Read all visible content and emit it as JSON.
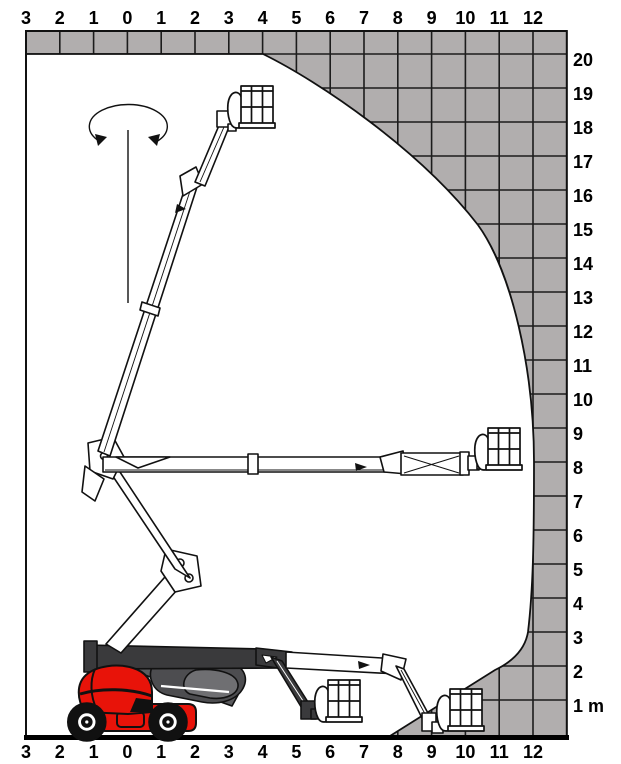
{
  "diagram": {
    "kind": "boom-lift-working-envelope",
    "unit": "m",
    "max_height_m": 20,
    "max_outreach_m": 12
  },
  "axes": {
    "top_labels": [
      "3",
      "2",
      "1",
      "0",
      "1",
      "2",
      "3",
      "4",
      "5",
      "6",
      "7",
      "8",
      "9",
      "10",
      "11",
      "12"
    ],
    "bottom_labels": [
      "3",
      "2",
      "1",
      "0",
      "1",
      "2",
      "3",
      "4",
      "5",
      "6",
      "7",
      "8",
      "9",
      "10",
      "11",
      "12"
    ],
    "right_labels": [
      "20",
      "19",
      "18",
      "17",
      "16",
      "15",
      "14",
      "13",
      "12",
      "11",
      "10",
      "9",
      "8",
      "7",
      "6",
      "5",
      "4",
      "3",
      "2",
      "1 m"
    ]
  },
  "chart_data": {
    "type": "area",
    "title": "Working envelope (outreach vs height)",
    "xlabel": "Outreach (m)",
    "ylabel": "Height (m)",
    "xlim": [
      -3,
      13
    ],
    "ylim": [
      0,
      21
    ],
    "envelope_boundary_m": [
      {
        "x": -3.0,
        "y": 20.0
      },
      {
        "x": 4.0,
        "y": 20.0
      },
      {
        "x": 5.4,
        "y": 19.4
      },
      {
        "x": 7.2,
        "y": 18.2
      },
      {
        "x": 8.0,
        "y": 17.8
      },
      {
        "x": 10.0,
        "y": 15.6
      },
      {
        "x": 11.1,
        "y": 13.6
      },
      {
        "x": 11.6,
        "y": 12.0
      },
      {
        "x": 12.0,
        "y": 8.0
      },
      {
        "x": 11.9,
        "y": 3.9
      },
      {
        "x": 11.8,
        "y": 2.9
      },
      {
        "x": 10.8,
        "y": 1.9
      },
      {
        "x": 7.8,
        "y": 0.0
      },
      {
        "x": -3.0,
        "y": 0.0
      }
    ]
  },
  "colors": {
    "envelope_gray": "#b1aeae",
    "grid_line": "#1c1c1c",
    "machine_red": "#e81309",
    "machine_dark": "#3a3a3c",
    "machine_mid": "#4d4d50",
    "machine_light": "#6f6f72",
    "outline": "#111111",
    "background": "#ffffff"
  }
}
